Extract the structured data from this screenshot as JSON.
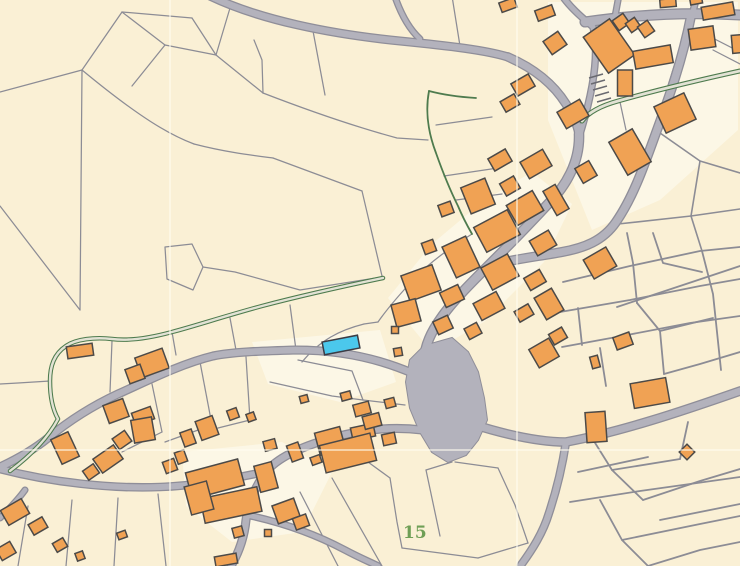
{
  "palette": {
    "background": "#faf0d5",
    "white_parcel": "#fcf7e6",
    "parcel_line": "#8c8c95",
    "road_fill": "#b3b2bc",
    "road_casing": "#8f8e99",
    "building_fill": "#f0a254",
    "building_stroke": "#4c4a48",
    "highlight_fill": "#4bc8ec",
    "highlight_stroke": "#3c3c44",
    "green_line": "#4e7b4e",
    "green_inner": "#e2e2d4",
    "seam": "#fffdf0",
    "label_color": "#6f9f56",
    "hatch_color": "#6a6a70"
  },
  "label": {
    "text": "15",
    "x": 403,
    "y": 538,
    "font_size": 17
  },
  "seams": [
    "M 170,0 L 170,566",
    "M 517,0 L 517,566",
    "M 0,450 L 740,450"
  ],
  "white_parcels": [
    "388,298 432,244 482,202 532,172 572,204 544,262 484,322 432,352",
    "182,452 282,442 332,472 302,532 232,542 186,506",
    "252,342 380,330 396,382 340,402 268,384",
    "548,2 738,2 738,130 660,200 592,230 548,120"
  ],
  "roads": [
    {
      "d": "M 210,-4 C 260,20 330,34 400,41 C 450,46 485,50 508,57",
      "w": 6.5
    },
    {
      "d": "M 394,-6 C 400,12 408,28 420,39",
      "w": 4.5
    },
    {
      "d": "M 508,57 C 538,70 556,88 566,104 C 574,117 578,126 579,134",
      "w": 7
    },
    {
      "d": "M 579,134 C 580,162 566,186 548,204 C 524,230 502,252 487,267 C 470,284 452,302 441,318 C 431,332 425,345 424,360",
      "w": 8
    },
    {
      "d": "M 691,16 C 682,62 668,100 657,130 C 645,163 634,196 616,222 C 603,241 584,248 562,252 C 540,256 516,259 495,264",
      "w": 7.5
    },
    {
      "d": "M 561,-6 C 570,8 585,20 593,27 C 600,55 592,95 580,134",
      "w": 5
    },
    {
      "d": "M 585,22 C 640,14 690,12 740,15",
      "w": 8.5
    },
    {
      "d": "M 619,-5 L 614,22",
      "w": 4.5
    },
    {
      "d": "M 697,-5 L 692,16",
      "w": 5
    },
    {
      "d": "M 472,424 C 510,436 540,442 566,442 C 620,432 680,412 740,391",
      "w": 7
    },
    {
      "d": "M 566,442 C 562,468 556,492 549,513 C 543,533 532,550 521,565",
      "w": 6
    },
    {
      "d": "M 422,430 C 390,426 360,430 332,438 C 300,447 277,458 266,472 C 254,488 248,505 246,520 C 244,540 238,554 231,566",
      "w": 6.5
    },
    {
      "d": "M 268,471 C 230,480 190,486 160,487 C 110,489 50,482 0,469",
      "w": 6
    },
    {
      "d": "M 247,515 C 280,522 315,534 345,550 C 360,558 370,562 378,566",
      "w": 5
    },
    {
      "d": "M 25,490 C 18,500 8,510 0,518",
      "w": 4.5
    },
    {
      "d": "M 412,373 C 370,355 330,350 296,350 C 260,351 232,352 213,356 C 180,364 145,382 118,394 C 90,407 65,424 48,438 C 32,451 15,460 0,467",
      "w": 6.5
    }
  ],
  "plaza": "424,346 452,338 468,352 478,372 484,398 487,420 478,440 466,455 448,462 432,452 420,432 410,408 406,382 410,360",
  "green_paths": [
    {
      "d": "M 740,71 C 690,82 650,92 618,101 C 600,106 588,113 582,121",
      "w": 5,
      "inner": 2.8
    },
    {
      "d": "M 383,278 C 340,287 300,296 262,306 C 225,316 195,326 172,332 C 150,338 128,341 112,339 C 95,337 76,339 66,346 C 54,354 50,366 50,381 C 50,398 53,410 58,419 C 48,438 30,456 10,471",
      "w": 4.5,
      "inner": 2.4
    },
    {
      "d": "M 429,91 C 425,112 428,132 436,153 C 442,170 450,190 458,206 C 463,218 468,227 472,234",
      "w": 1.8,
      "inner": 0
    },
    {
      "d": "M 429,91 C 444,95 460,97 476,98",
      "w": 1.8,
      "inner": 0
    }
  ],
  "parcel_lines": [
    [
      "M 0,92 L 82,70"
    ],
    [
      "M 82,70 L 81,190 L 80,310"
    ],
    [
      "M 0,206 L 80,310"
    ],
    [
      "M 82,70 L 122,12"
    ],
    [
      "M 122,12 L 192,18"
    ],
    [
      "M 122,12 L 165,45"
    ],
    [
      "M 165,45 L 132,86"
    ],
    [
      "M 192,18 L 216,55"
    ],
    [
      "M 165,45 L 216,55"
    ],
    [
      "M 216,55 L 230,8"
    ],
    [
      "M 216,55 L 263,93"
    ],
    [
      "M 82,70 C 140,118 170,135 194,144"
    ],
    [
      "M 194,144 C 225,152 250,155 273,158"
    ],
    [
      "M 273,158 L 362,191"
    ],
    [
      "M 362,191 L 382,276"
    ],
    [
      "M 263,93 L 262,60 L 254,40"
    ],
    [
      "M 263,93 C 320,115 360,128 397,138 L 428,140"
    ],
    [
      "M 313,31 L 325,95"
    ],
    [
      "M 452,-4 L 460,46"
    ],
    [
      "M 165,247 L 192,244 L 203,267 L 193,290 L 167,279 Z"
    ],
    [
      "M 203,267 L 235,272 L 300,290 L 382,277"
    ],
    [
      "M 436,125 L 492,117"
    ],
    [
      "M 444,176 L 498,168"
    ],
    [
      "M 456,200 L 502,194"
    ],
    [
      "M 472,234 C 450,248 430,262 415,278"
    ],
    [
      "M 415,278 C 398,296 385,312 378,322"
    ],
    [
      "M 302,362 C 320,340 340,330 364,324"
    ],
    [
      "M 364,324 L 378,322"
    ],
    [
      "M 298,360 L 352,371 L 363,400"
    ],
    [
      "M 270,382 L 332,396 L 363,400"
    ],
    [
      "M 363,400 L 405,405"
    ],
    [
      "M 172,332 L 176,355"
    ],
    [
      "M 112,341 L 110,392"
    ],
    [
      "M 230,318 L 236,350"
    ],
    [
      "M 296,350 L 290,305"
    ],
    [
      "M 50,381 L 18,383 L 0,384"
    ],
    [
      "M 152,384 L 162,432"
    ],
    [
      "M 200,362 L 212,425"
    ],
    [
      "M 212,425 L 165,442"
    ],
    [
      "M 162,432 L 122,452"
    ],
    [
      "M 246,357 L 250,420"
    ],
    [
      "M 250,420 L 218,428"
    ],
    [
      "M 28,506 L 18,566"
    ],
    [
      "M 72,500 L 66,566"
    ],
    [
      "M 118,498 L 114,566"
    ],
    [
      "M 158,494 L 166,566"
    ],
    [
      "M 300,492 L 338,566"
    ],
    [
      "M 332,478 L 382,566"
    ],
    [
      "M 368,462 L 390,478"
    ],
    [
      "M 390,478 L 397,522 L 402,548"
    ],
    [
      "M 426,470 L 440,536"
    ],
    [
      "M 402,548 L 478,558"
    ],
    [
      "M 426,470 L 452,462"
    ],
    [
      "M 478,558 L 528,543"
    ],
    [
      "M 455,462 L 498,468"
    ],
    [
      "M 498,468 L 515,505 L 528,543"
    ],
    [
      "M 563,282 L 630,266 L 700,251 L 740,247",
      1.8
    ],
    [
      "M 560,312 L 630,300 L 700,286 L 740,279",
      1.8
    ],
    [
      "M 617,307 L 680,286 L 740,266",
      1.8
    ],
    [
      "M 562,347 L 622,336 L 690,323 L 740,316",
      1.8
    ],
    [
      "M 578,308 L 582,345",
      1.8
    ],
    [
      "M 600,348 L 606,386",
      1.8
    ],
    [
      "M 627,233 L 633,263 L 637,303",
      1.8
    ],
    [
      "M 653,233 L 663,263 L 702,272",
      1.8
    ],
    [
      "M 637,303 L 660,331 L 664,374",
      1.8
    ],
    [
      "M 702,251 L 713,294 L 721,370",
      1.8
    ],
    [
      "M 660,331 L 713,318",
      1.8
    ],
    [
      "M 664,374 L 700,364 L 740,352",
      1.8
    ],
    [
      "M 697,30 L 740,52"
    ],
    [
      "M 660,133 L 700,161 L 740,173",
      1.6
    ],
    [
      "M 700,161 L 691,216 L 740,209",
      1.6
    ],
    [
      "M 618,224 L 691,216",
      1.6
    ],
    [
      "M 691,216 L 702,251",
      1.6
    ],
    [
      "M 676,60 L 666,92"
    ],
    [
      "M 713,50 L 740,64"
    ],
    [
      "M 620,102 L 626,130"
    ],
    [
      "M 592,438 L 612,470 L 643,500",
      1.8
    ],
    [
      "M 612,470 L 680,459",
      1.8
    ],
    [
      "M 643,500 L 700,481 L 740,469",
      1.8
    ],
    [
      "M 660,520 L 740,504",
      1.8
    ],
    [
      "M 600,500 L 622,540 L 648,566",
      1.8
    ],
    [
      "M 680,459 L 688,422",
      1.8
    ],
    [
      "M 578,472 L 648,457",
      1.8
    ],
    [
      "M 570,502 L 640,491 L 740,477",
      1.8
    ],
    [
      "M 622,540 L 700,524 L 740,516",
      1.8
    ],
    [
      "M 648,566 L 700,550 L 740,542",
      1.8
    ]
  ],
  "buildings": [
    [
      609,
      46,
      32,
      44,
      -35
    ],
    [
      621,
      22,
      13,
      12,
      -35
    ],
    [
      633,
      25,
      11,
      11,
      -35
    ],
    [
      646,
      29,
      12,
      13,
      -35
    ],
    [
      702,
      38,
      25,
      21,
      -8
    ],
    [
      653,
      57,
      38,
      18,
      -10
    ],
    [
      625,
      83,
      15,
      26,
      0
    ],
    [
      573,
      114,
      26,
      19,
      -30
    ],
    [
      675,
      113,
      33,
      29,
      -25
    ],
    [
      630,
      152,
      27,
      38,
      -30
    ],
    [
      586,
      172,
      16,
      17,
      -30
    ],
    [
      545,
      13,
      18,
      11,
      -20
    ],
    [
      508,
      5,
      16,
      10,
      -20
    ],
    [
      555,
      43,
      18,
      16,
      -35
    ],
    [
      523,
      85,
      20,
      14,
      -30
    ],
    [
      510,
      103,
      16,
      12,
      -30
    ],
    [
      718,
      11,
      32,
      13,
      -10
    ],
    [
      737,
      44,
      10,
      18,
      -5
    ],
    [
      668,
      3,
      16,
      8,
      -5
    ],
    [
      696,
      0,
      12,
      8,
      -10
    ],
    [
      500,
      160,
      20,
      14,
      -30
    ],
    [
      536,
      164,
      26,
      19,
      -30
    ],
    [
      510,
      186,
      16,
      14,
      -30
    ],
    [
      478,
      196,
      26,
      28,
      -22
    ],
    [
      525,
      208,
      30,
      23,
      -30
    ],
    [
      556,
      200,
      14,
      28,
      -30
    ],
    [
      446,
      209,
      13,
      12,
      -20
    ],
    [
      497,
      231,
      38,
      28,
      -28
    ],
    [
      543,
      243,
      22,
      17,
      -30
    ],
    [
      461,
      257,
      26,
      34,
      -25
    ],
    [
      500,
      272,
      30,
      25,
      -28
    ],
    [
      535,
      280,
      18,
      14,
      -30
    ],
    [
      429,
      247,
      12,
      12,
      -20
    ],
    [
      421,
      283,
      33,
      27,
      -20
    ],
    [
      452,
      296,
      20,
      16,
      -25
    ],
    [
      489,
      306,
      26,
      19,
      -28
    ],
    [
      524,
      313,
      16,
      12,
      -30
    ],
    [
      406,
      313,
      25,
      23,
      -15
    ],
    [
      443,
      325,
      16,
      14,
      -25
    ],
    [
      473,
      331,
      14,
      12,
      -28
    ],
    [
      395,
      330,
      7,
      7,
      0
    ],
    [
      549,
      304,
      20,
      25,
      -30
    ],
    [
      558,
      336,
      15,
      12,
      -30
    ],
    [
      544,
      353,
      23,
      21,
      -30
    ],
    [
      398,
      352,
      8,
      8,
      -10
    ],
    [
      346,
      396,
      10,
      8,
      -15
    ],
    [
      304,
      399,
      8,
      7,
      -15
    ],
    [
      362,
      409,
      16,
      12,
      -15
    ],
    [
      390,
      403,
      10,
      9,
      -15
    ],
    [
      363,
      432,
      23,
      13,
      -12
    ],
    [
      389,
      439,
      13,
      11,
      -12
    ],
    [
      330,
      441,
      26,
      23,
      -15
    ],
    [
      372,
      421,
      17,
      13,
      -15
    ],
    [
      348,
      453,
      52,
      28,
      -14
    ],
    [
      596,
      427,
      20,
      30,
      -4
    ],
    [
      650,
      393,
      36,
      25,
      -10
    ],
    [
      623,
      341,
      17,
      13,
      -20
    ],
    [
      600,
      263,
      26,
      22,
      -30
    ],
    [
      595,
      362,
      8,
      12,
      -15
    ],
    [
      687,
      452,
      11,
      11,
      45
    ],
    [
      143,
      416,
      20,
      13,
      -20
    ],
    [
      207,
      428,
      18,
      20,
      -20
    ],
    [
      188,
      438,
      12,
      15,
      -20
    ],
    [
      233,
      414,
      10,
      10,
      -20
    ],
    [
      251,
      417,
      8,
      8,
      -20
    ],
    [
      215,
      479,
      54,
      27,
      -15
    ],
    [
      231,
      505,
      58,
      25,
      -12
    ],
    [
      199,
      498,
      23,
      29,
      -15
    ],
    [
      266,
      477,
      18,
      27,
      -15
    ],
    [
      286,
      511,
      23,
      19,
      -20
    ],
    [
      301,
      522,
      14,
      12,
      -20
    ],
    [
      238,
      532,
      10,
      10,
      -15
    ],
    [
      270,
      445,
      12,
      10,
      -15
    ],
    [
      295,
      452,
      12,
      17,
      -20
    ],
    [
      316,
      460,
      10,
      8,
      -20
    ],
    [
      268,
      533,
      7,
      7,
      0
    ],
    [
      181,
      457,
      10,
      12,
      -20
    ],
    [
      226,
      560,
      22,
      10,
      -10
    ],
    [
      80,
      351,
      26,
      12,
      -8
    ],
    [
      152,
      363,
      29,
      21,
      -20
    ],
    [
      135,
      374,
      16,
      15,
      -20
    ],
    [
      116,
      411,
      21,
      19,
      -20
    ],
    [
      143,
      430,
      21,
      23,
      -10
    ],
    [
      65,
      448,
      19,
      27,
      -25
    ],
    [
      15,
      512,
      24,
      17,
      -30
    ],
    [
      38,
      526,
      16,
      12,
      -30
    ],
    [
      108,
      459,
      25,
      17,
      -35
    ],
    [
      91,
      472,
      13,
      11,
      -35
    ],
    [
      122,
      440,
      15,
      13,
      -35
    ],
    [
      60,
      545,
      12,
      10,
      -30
    ],
    [
      170,
      466,
      12,
      12,
      -20
    ],
    [
      80,
      556,
      8,
      8,
      -20
    ],
    [
      122,
      535,
      9,
      7,
      -20
    ],
    [
      6,
      551,
      16,
      13,
      -30
    ]
  ],
  "hatch_lines": [
    "M 589,78 L 603,74",
    "M 591,84 L 605,80",
    "M 593,90 L 607,86",
    "M 595,96 L 609,92",
    "M 597,102 L 611,98"
  ],
  "highlight": {
    "cx": 341,
    "cy": 345,
    "w": 36,
    "h": 13,
    "rot": -11
  }
}
